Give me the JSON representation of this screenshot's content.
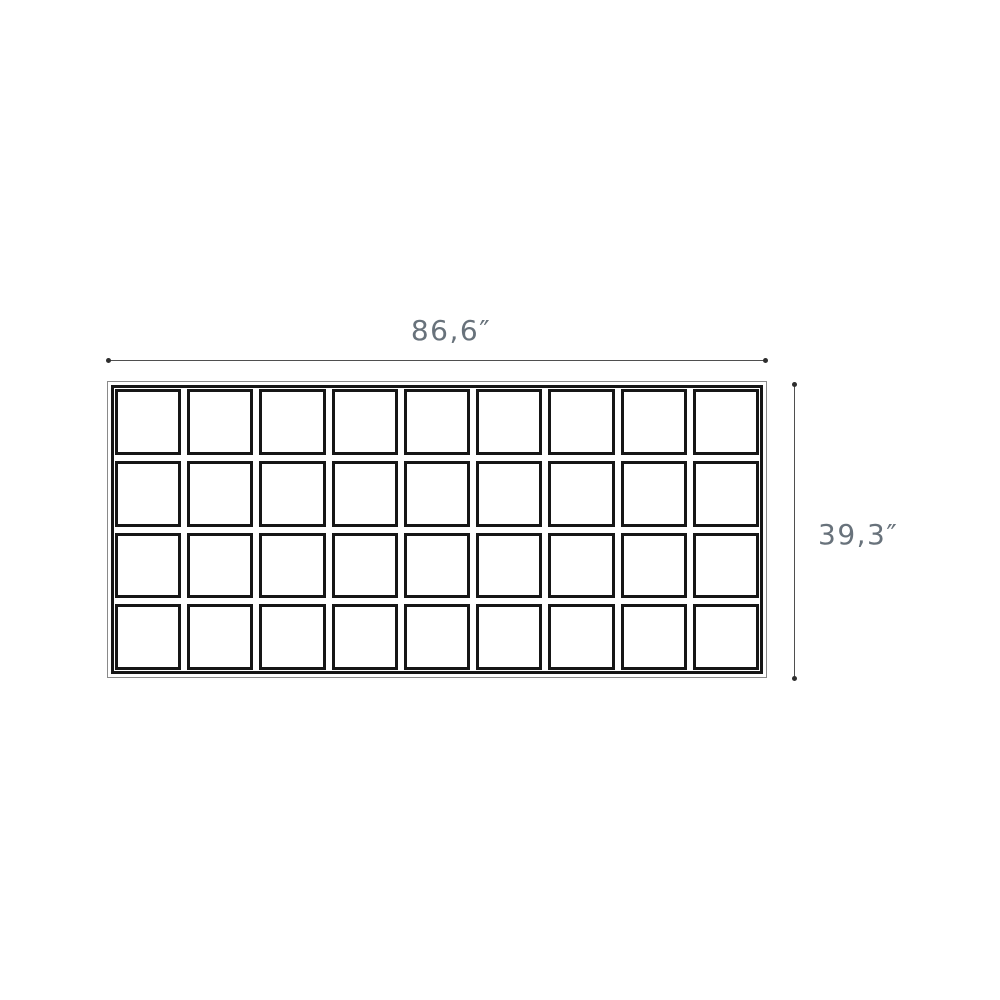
{
  "drawing": {
    "width_dimension": {
      "label": "86,6″"
    },
    "height_dimension": {
      "label": "39,3″"
    },
    "grid": {
      "columns": 9,
      "rows": 4,
      "cell_count": 36
    },
    "colors": {
      "grid_line": "#161616",
      "panel_outline": "#8a8a8a",
      "dimension_line": "#4f4f4f",
      "dimension_dot": "#2e2e2e",
      "dimension_text": "#68727b",
      "background": "#ffffff"
    }
  }
}
